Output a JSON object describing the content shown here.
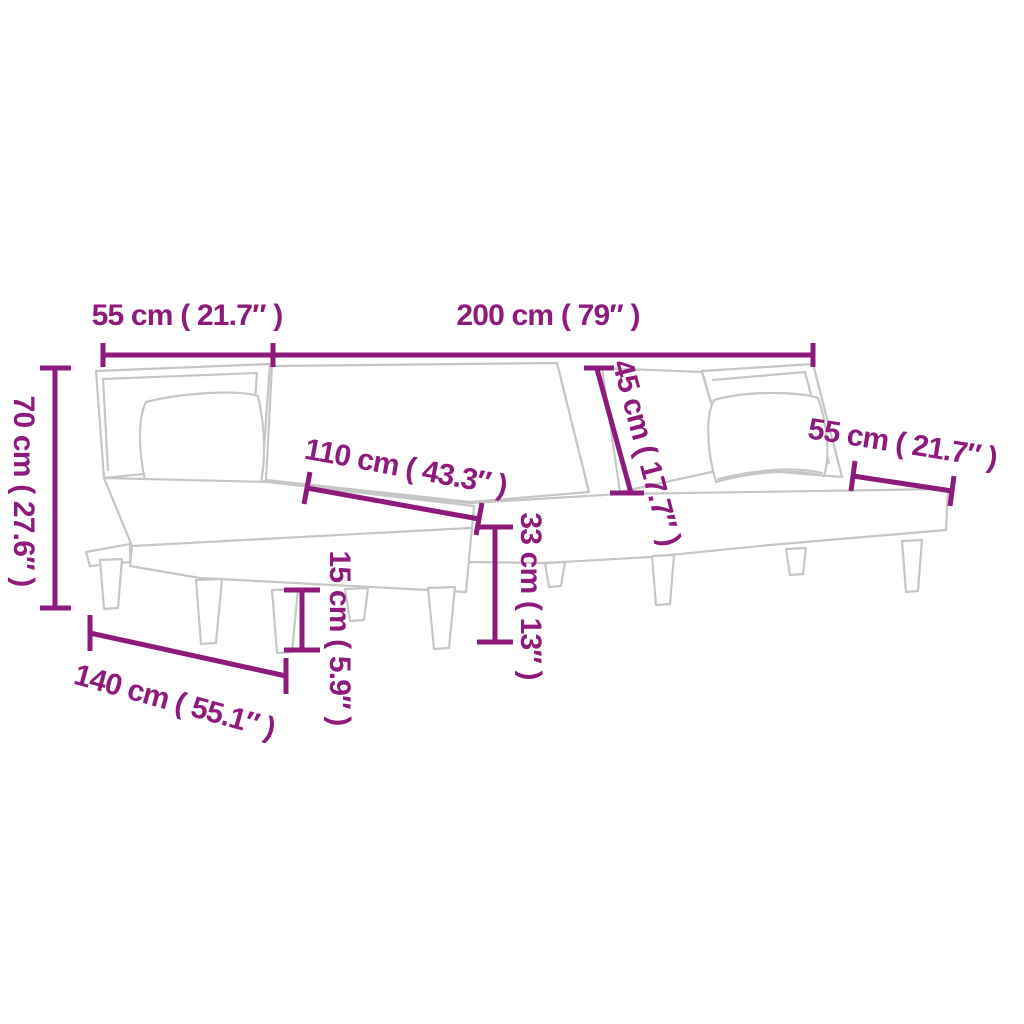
{
  "meta": {
    "type": "product-dimension-diagram",
    "subject": "L-shaped sofa bed line drawing with measurements"
  },
  "colors": {
    "dimension_annotation": "#8e1b7c",
    "product_outline": "#c6c6c6",
    "background": "#ffffff"
  },
  "product": {
    "parts": [
      "left-backrest-with-pillow",
      "fold-flat-bed-surface",
      "right-backrest-with-pillow",
      "chaise-section",
      "side-ledge",
      "tapered-legs"
    ]
  },
  "dimensions": [
    {
      "id": "left-section-width",
      "label": "55 cm ( 21.7″ )",
      "cm": "55",
      "inches": "21.7"
    },
    {
      "id": "main-section-width",
      "label": "200 cm ( 79″ )",
      "cm": "200",
      "inches": "79"
    },
    {
      "id": "overall-height",
      "label": "70 cm ( 27.6″ )",
      "cm": "70",
      "inches": "27.6"
    },
    {
      "id": "chaise-surface-width",
      "label": "110 cm ( 43.3″ )",
      "cm": "110",
      "inches": "43.3"
    },
    {
      "id": "backrest-depth",
      "label": "45 cm ( 17.7″ )",
      "cm": "45",
      "inches": "17.7"
    },
    {
      "id": "seat-height",
      "label": "33 cm ( 13″ )",
      "cm": "33",
      "inches": "13"
    },
    {
      "id": "leg-height",
      "label": "15 cm ( 5.9″ )",
      "cm": "15",
      "inches": "5.9"
    },
    {
      "id": "right-seat-depth",
      "label": "55 cm ( 21.7″ )",
      "cm": "55",
      "inches": "21.7"
    },
    {
      "id": "chaise-length",
      "label": "140 cm ( 55.1″ )",
      "cm": "140",
      "inches": "55.1"
    }
  ]
}
